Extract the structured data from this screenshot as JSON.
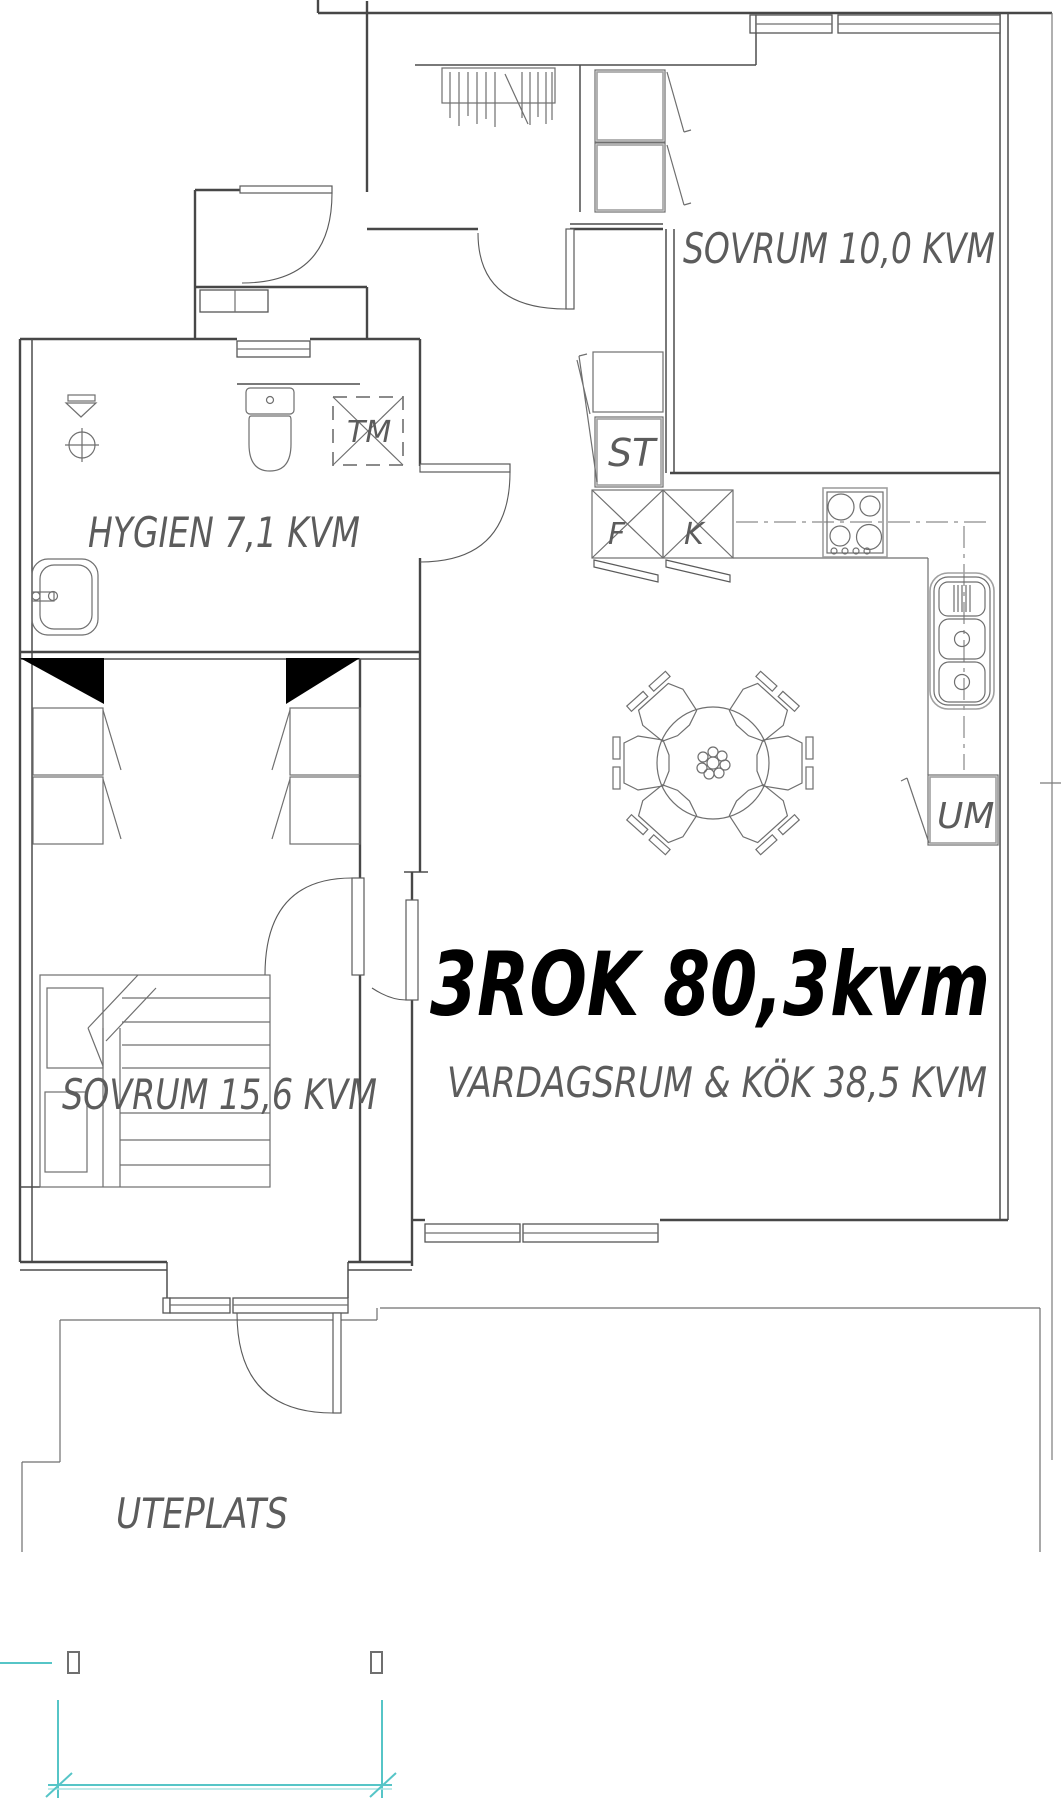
{
  "title": {
    "text": "3ROK 80,3kvm"
  },
  "rooms": {
    "bedroom1": {
      "label": "SOVRUM 10,0 KVM"
    },
    "bathroom": {
      "label": "HYGIEN 7,1 KVM"
    },
    "living_kitchen": {
      "label": "VARDAGSRUM & KÖK 38,5 KVM"
    },
    "bedroom2": {
      "label": "SOVRUM 15,6 KVM"
    },
    "patio": {
      "label": "UTEPLATS"
    }
  },
  "appliances": {
    "tm": {
      "label": "TM"
    },
    "st": {
      "label": "ST"
    },
    "fridge": {
      "label": "F"
    },
    "freezer": {
      "label": "K"
    },
    "um": {
      "label": "UM"
    }
  },
  "colors": {
    "wall": "#474747",
    "furniture": "#6f6f6f",
    "label_text": "#5c5c5c",
    "title_text": "#000000",
    "boundary": "#56c5c7",
    "boundary_light": "#ace4e4"
  }
}
